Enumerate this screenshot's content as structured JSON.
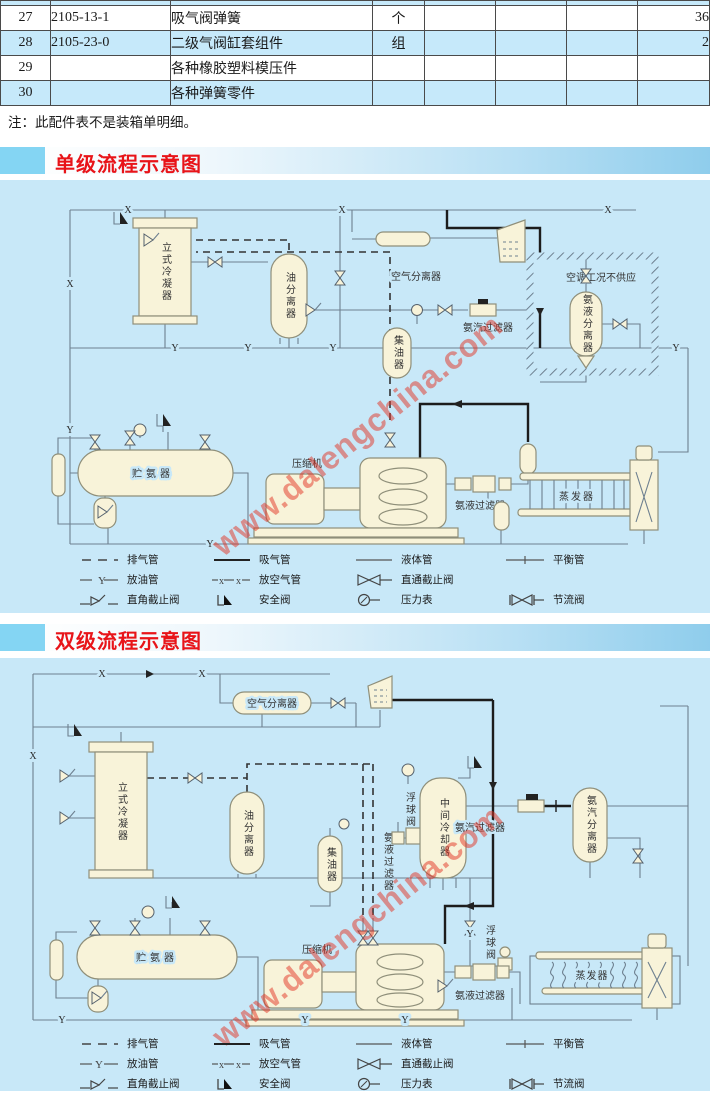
{
  "table": {
    "rows": [
      {
        "no": "27",
        "part_no": "2105-13-1",
        "name": "吸气阀弹簧",
        "unit": "个",
        "qty": "36"
      },
      {
        "no": "28",
        "part_no": "2105-23-0",
        "name": "二级气阀缸套组件",
        "unit": "组",
        "qty": "2"
      },
      {
        "no": "29",
        "part_no": "",
        "name": "各种橡胶塑料模压件",
        "unit": "",
        "qty": ""
      },
      {
        "no": "30",
        "part_no": "",
        "name": "各种弹簧零件",
        "unit": "",
        "qty": ""
      }
    ],
    "note": "注：此配件表不是装箱单明细。"
  },
  "sections": [
    {
      "title": "单级流程示意图",
      "labels": {
        "condenser": "立式冷凝器",
        "oil_separator": "油分离器",
        "air_separator": "空气分离器",
        "no_supply_note": "空调工况不供应",
        "vapor_filter": "氨汽过滤器",
        "liquid_separator": "氨液分离器",
        "oil_collector": "集油器",
        "receiver": "贮氨器",
        "compressor": "压缩机",
        "liquid_filter": "氨液过滤器",
        "evaporator": "蒸发器"
      }
    },
    {
      "title": "双级流程示意图",
      "labels": {
        "air_separator": "空气分离器",
        "condenser": "立式冷凝器",
        "oil_separator": "油分离器",
        "oil_collector": "集油器",
        "liquid_filter_mid": "氨液过滤器",
        "float_valve_1": "浮球阀",
        "inter_cooler": "中间冷却器",
        "vapor_filter": "氨汽过滤器",
        "vapor_separator": "氨汽分离器",
        "receiver": "贮氨器",
        "compressor": "压缩机",
        "float_valve_2": "浮球阀",
        "liquid_filter": "氨液过滤器",
        "evaporator": "蒸发器"
      }
    }
  ],
  "pipe_labels": {
    "x": "X",
    "y": "Y"
  },
  "legend": {
    "items": [
      {
        "id": "exhaust",
        "label": "排气管"
      },
      {
        "id": "suction",
        "label": "吸气管"
      },
      {
        "id": "liquid",
        "label": "液体管"
      },
      {
        "id": "balance",
        "label": "平衡管"
      },
      {
        "id": "oil-drain",
        "label": "放油管"
      },
      {
        "id": "air-release",
        "label": "放空气管"
      },
      {
        "id": "globe-valve",
        "label": "直通截止阀"
      },
      {
        "id": "angle-valve",
        "label": "直角截止阀"
      },
      {
        "id": "safety-valve",
        "label": "安全阀"
      },
      {
        "id": "pressure-gauge",
        "label": "压力表"
      },
      {
        "id": "throttle-valve",
        "label": "节流阀"
      }
    ]
  },
  "watermark": {
    "text": "www.dalengchina.com"
  },
  "colors": {
    "accent_red": "#e81419",
    "panel_blue": "#c8e8f8",
    "row_alt_blue": "#c6e9fa",
    "vessel_cream": "#f8f3d9",
    "watermark_red": "#e23222"
  }
}
